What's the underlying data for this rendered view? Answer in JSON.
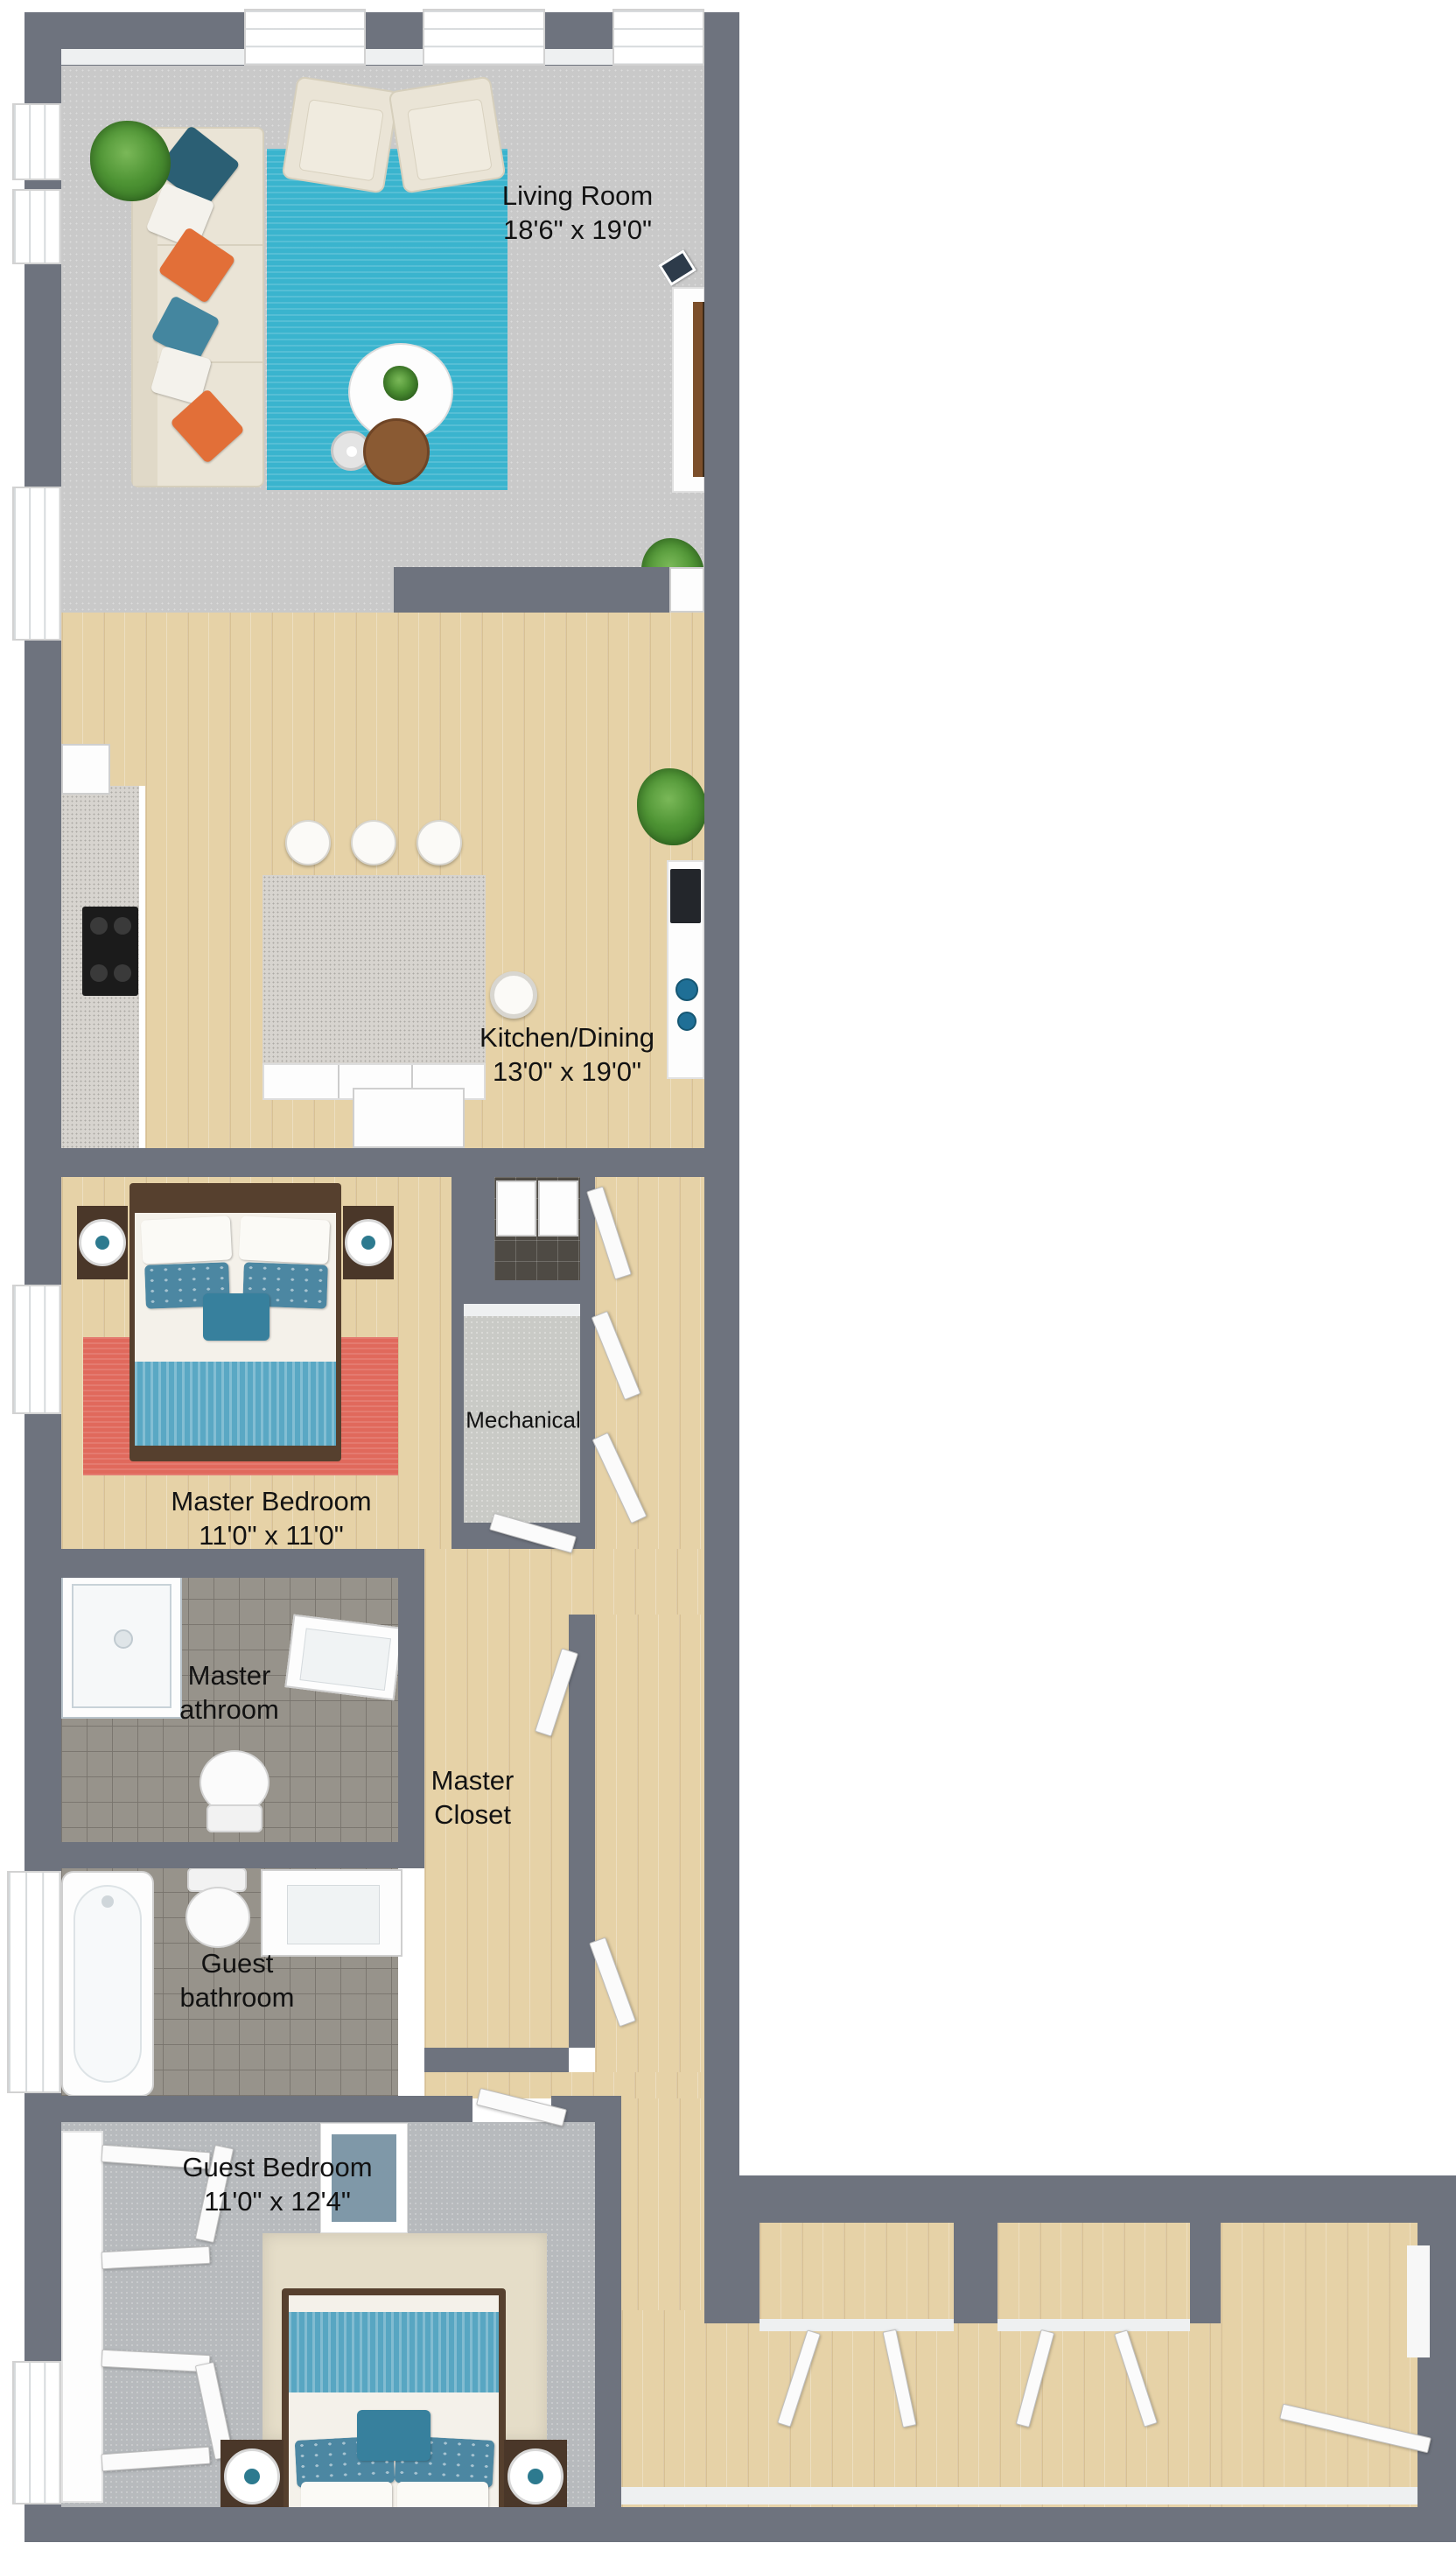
{
  "plan": {
    "type": "3d-floor-plan",
    "labels": {
      "living_room": "Living Room\n18'6\" x 19'0\"",
      "kitchen_dining": "Kitchen/Dining\n13'0\" x 19'0\"",
      "mechanical": "Mechanical",
      "master_bedroom": "Master Bedroom\n11'0\" x 11'0\"",
      "master_bathroom": "Master\nathroom",
      "master_closet": "Master\nCloset",
      "guest_bathroom": "Guest\nbathroom",
      "guest_bedroom": "Guest Bedroom\n11'0\" x 12'4\""
    },
    "rooms": [
      {
        "name": "Living Room",
        "dimensions": "18'6\" x 19'0\""
      },
      {
        "name": "Kitchen/Dining",
        "dimensions": "13'0\" x 19'0\""
      },
      {
        "name": "Mechanical",
        "dimensions": ""
      },
      {
        "name": "Master Bedroom",
        "dimensions": "11'0\" x 11'0\""
      },
      {
        "name": "Master athroom",
        "dimensions": ""
      },
      {
        "name": "Master Closet",
        "dimensions": ""
      },
      {
        "name": "Guest bathroom",
        "dimensions": ""
      },
      {
        "name": "Guest Bedroom",
        "dimensions": "11'0\" x 12'4\""
      }
    ],
    "colors": {
      "wall": "#6e737e",
      "wood_floor": "#e6d2a7",
      "living_carpet": "#c9c9c9",
      "guest_carpet": "#b7babd",
      "bath_tile": "#97938b",
      "teal_rug": "#3ab4ce",
      "red_rug": "#e0695c",
      "beige_rug": "#e5ddc8",
      "teal_blanket": "#5aa8c4",
      "label_text": "#121212"
    }
  }
}
